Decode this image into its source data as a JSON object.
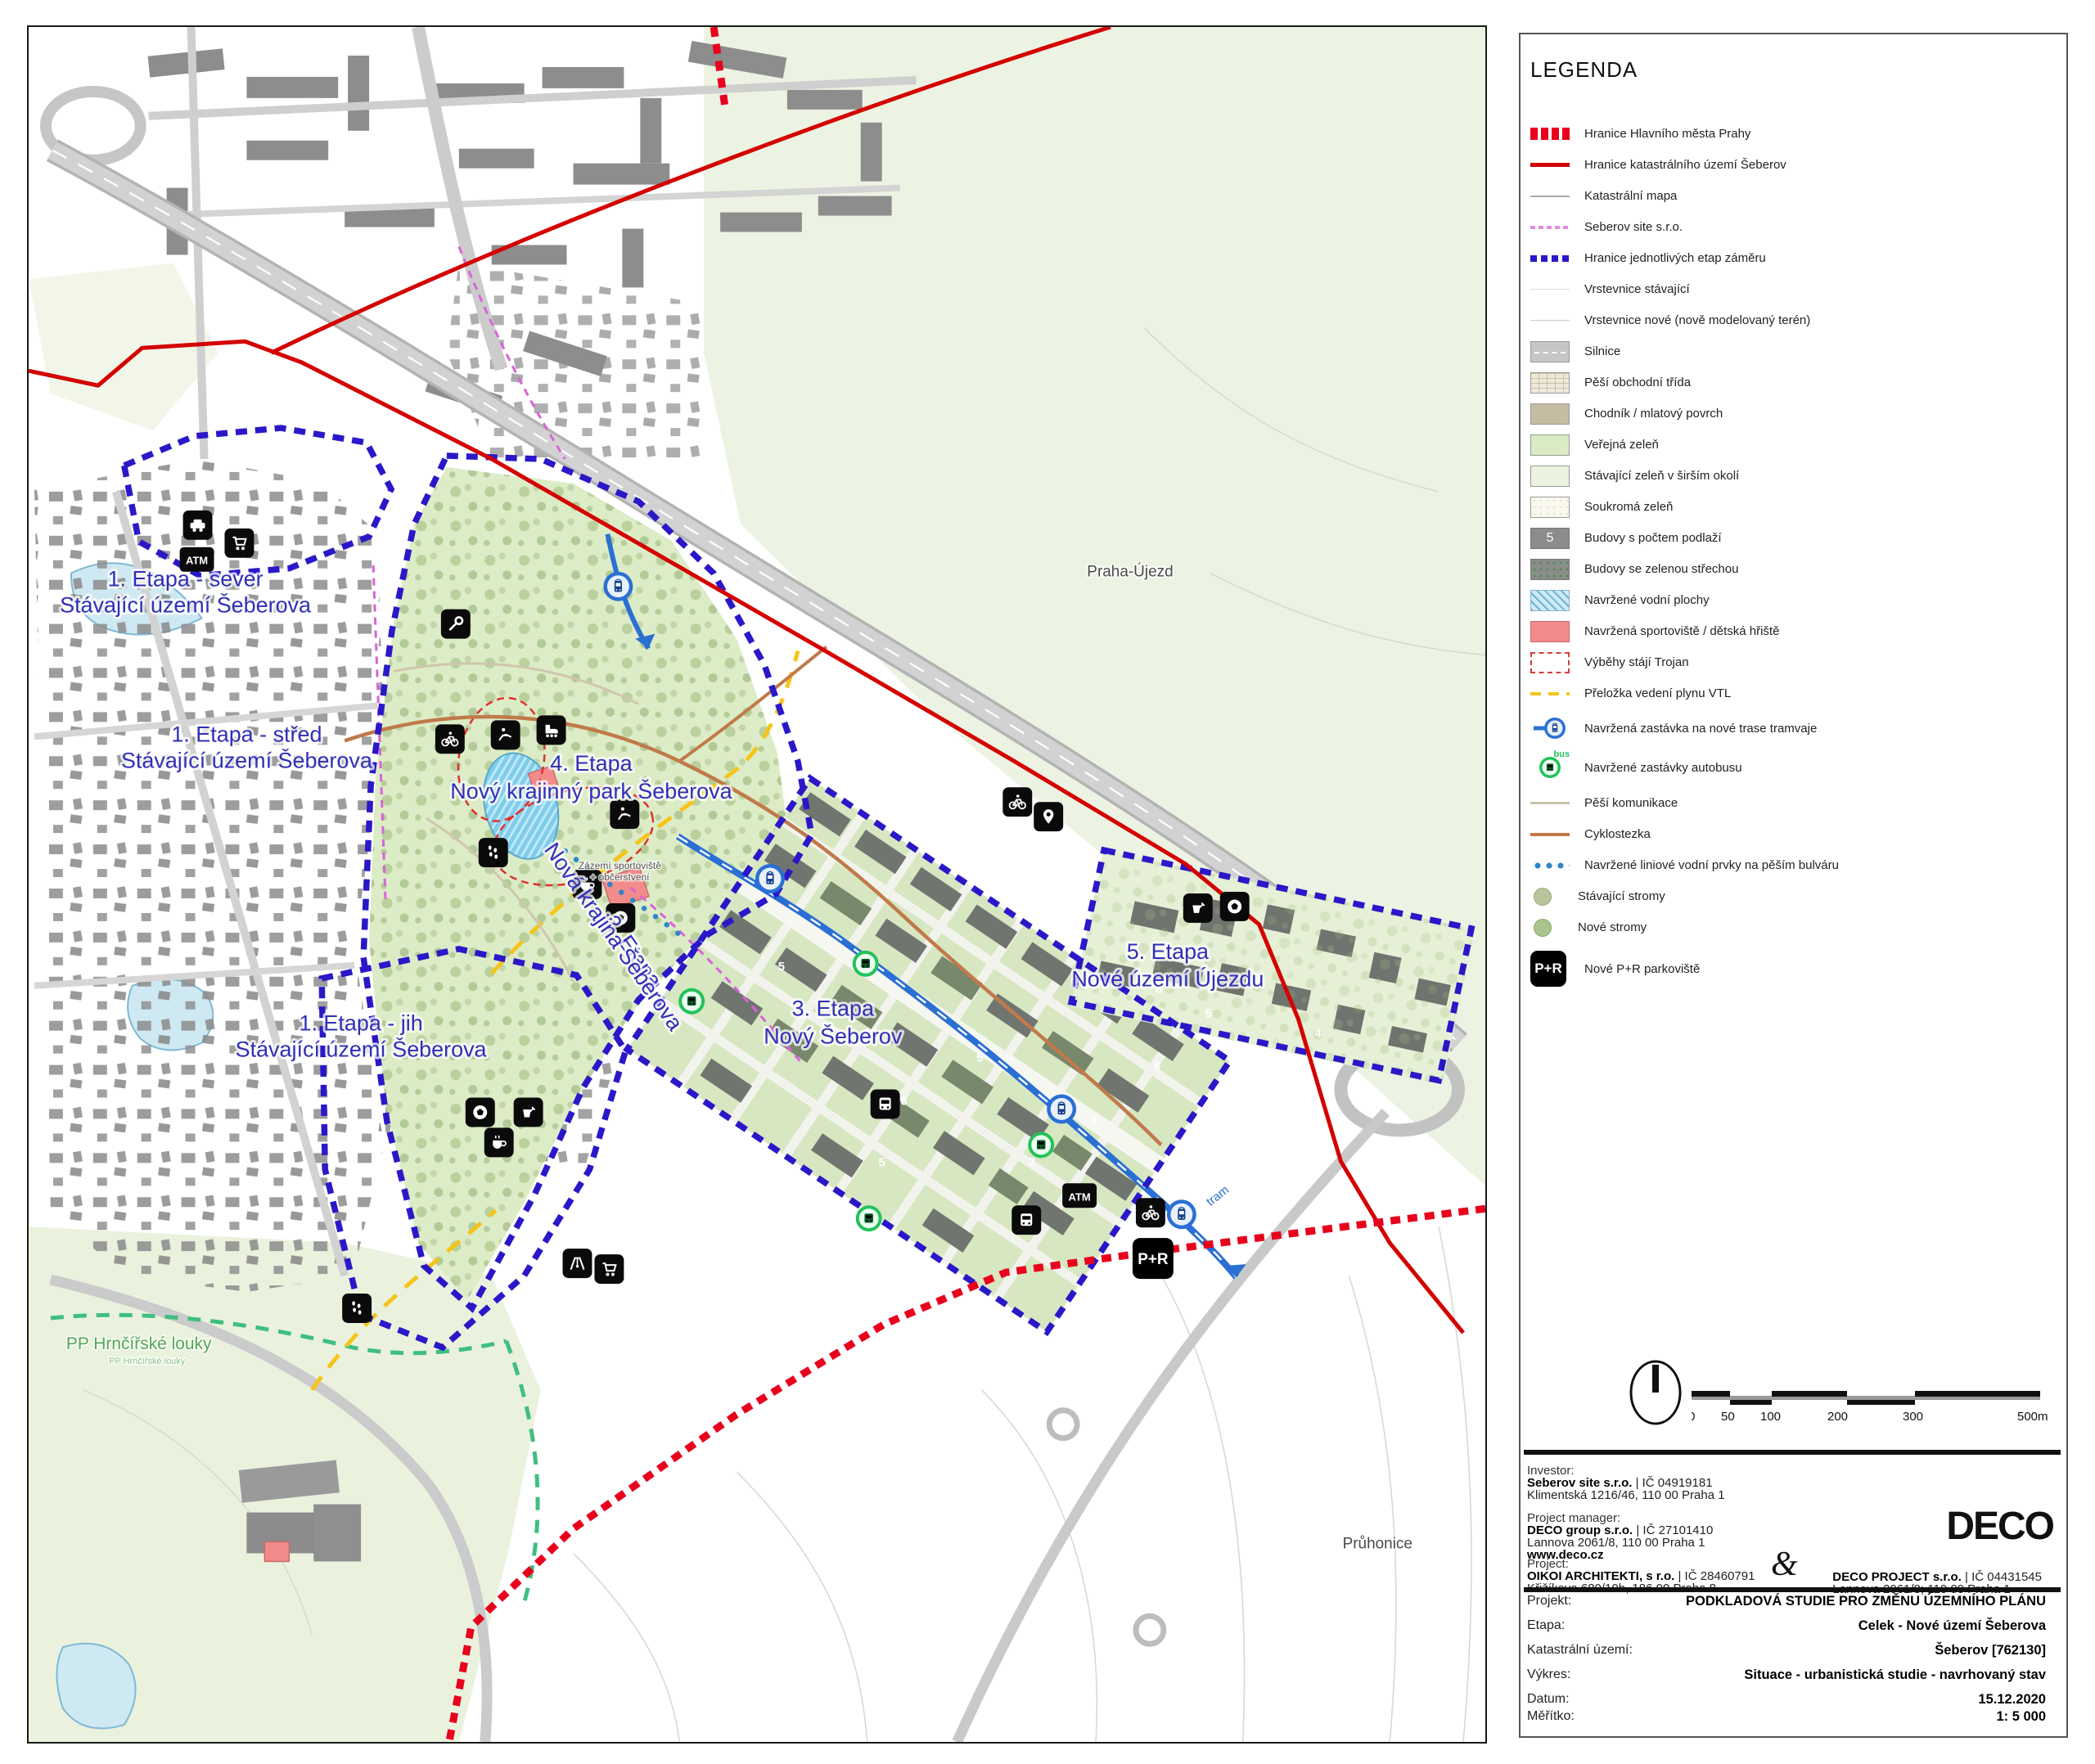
{
  "colors": {
    "etapa_boundary": "#2a18c8",
    "city_boundary_dotted": "#e8001c",
    "cadastre_line": "#d40000",
    "seberov_site_line": "#e08ae0",
    "public_green": "#d9ecc4",
    "park_green": "#dcecc6",
    "water": "#8fd2ee",
    "sport_red": "#f28c8a",
    "gas_yellow": "#f6c41a",
    "tram_blue": "#2a6fd4",
    "bus_green": "#23c25a",
    "label_blue": "#2f2fb8"
  },
  "map": {
    "labels": {
      "etapa1_sever_1": "1. Etapa - sever",
      "etapa1_sever_2": "Stávající území Šeberova",
      "etapa1_stred_1": "1. Etapa - střed",
      "etapa1_stred_2": "Stávající území Šeberova",
      "etapa1_jih_1": "1. Etapa - jih",
      "etapa1_jih_2": "Stávající území Šeberova",
      "etapa2_1": "2. Etapa",
      "etapa2_2": "Nová krajina Šeberova",
      "etapa3_1": "3. Etapa",
      "etapa3_2": "Nový Šeberov",
      "etapa4_1": "4. Etapa",
      "etapa4_2": "Nový krajinný park Šeberova",
      "etapa5_1": "5. Etapa",
      "etapa5_2": "Nové území Újezdu",
      "praha_ujezd": "Praha-Újezd",
      "pruhonice": "Průhonice",
      "pp_louky": "PP Hrnčířské louky",
      "pp_louky_sub": "PP Hrnčířské louky",
      "tram": "tram",
      "zazemi_1": "Zázemí sportoviště",
      "zazemi_2": "+ občerstvení"
    },
    "badges": {
      "atm": "ATM",
      "pr": "P+R"
    },
    "floors": [
      "5",
      "4",
      "6",
      "5",
      "7",
      "4",
      "6",
      "5",
      "8",
      "5",
      "5",
      "4"
    ],
    "icons": {
      "car-icon": "car service",
      "atm-icon": "ATM",
      "cart-icon": "shop",
      "wrench-icon": "services",
      "bike-icon": "cycling",
      "horse-icon": "horse riding",
      "skate-icon": "skating",
      "footprints-icon": "walking trail",
      "coffee-icon": "refreshment",
      "ball-icon": "sports field",
      "bucket-icon": "playground sandpit",
      "playground-icon": "playground",
      "pin-icon": "point of interest",
      "bus-front-icon": "bus station",
      "tram-stop-icon": "proposed tram stop",
      "bus-stop-icon": "proposed bus stop",
      "pr-icon": "P+R parking"
    }
  },
  "legend": {
    "title": "LEGENDA",
    "items": [
      {
        "label": "Hranice Hlavního města Prahy"
      },
      {
        "label": "Hranice katastrálního území Šeberov"
      },
      {
        "label": "Katastrální mapa"
      },
      {
        "label": "Seberov site s.r.o."
      },
      {
        "label": "Hranice jednotlivých etap záměru"
      },
      {
        "label": "Vrstevnice stávající"
      },
      {
        "label": "Vrstevnice nové (nově modelovaný terén)"
      },
      {
        "label": "Silnice"
      },
      {
        "label": "Pěší obchodní třída"
      },
      {
        "label": "Chodník / mlatový povrch"
      },
      {
        "label": "Veřejná zeleň"
      },
      {
        "label": "Stávající zeleň v širším okolí"
      },
      {
        "label": "Soukromá zeleň"
      },
      {
        "label": "Budovy s počtem podlaží",
        "badge": "5"
      },
      {
        "label": "Budovy se zelenou střechou"
      },
      {
        "label": "Navržené vodní plochy"
      },
      {
        "label": "Navržená sportoviště / dětská hřiště"
      },
      {
        "label": "Výběhy stájí Trojan"
      },
      {
        "label": "Přeložka vedení plynu VTL"
      },
      {
        "label": "Navržená zastávka na nové trase tramvaje"
      },
      {
        "label": "Navržené zastávky autobusu",
        "badge": "bus"
      },
      {
        "label": "Pěší komunikace"
      },
      {
        "label": "Cyklostezka"
      },
      {
        "label": "Navržené liniové vodní prvky na pěším bulváru"
      },
      {
        "label": "Stávající stromy"
      },
      {
        "label": "Nové stromy"
      },
      {
        "label": "Nové P+R parkoviště",
        "badge": "P+R"
      }
    ]
  },
  "scalebar": {
    "ticks": [
      "0",
      "50",
      "100",
      "200",
      "300",
      "500m"
    ]
  },
  "titleblock": {
    "investor_label": "Investor:",
    "investor_name": "Seberov site  s.r.o.",
    "investor_reg": "| IČ 04919181",
    "investor_addr": "Klimentská 1216/46, 110 00 Praha 1",
    "pm_label": "Project manager:",
    "pm_name": "DECO group s.r.o.",
    "pm_reg": "| IČ 27101410",
    "pm_addr": "Lannova 2061/8, 110 00 Praha 1",
    "pm_web": "www.deco.cz",
    "project_label": "Project:",
    "arch_name": "OIKOI ARCHITEKTI, s r.o.",
    "arch_reg": "| IČ 28460791",
    "arch_addr": "Křižíkova 680/10b, 186 00 Praha 8",
    "ampersand": "&",
    "deco_project_name": "DECO PROJECT s.r.o.",
    "deco_project_reg": "| IČ 04431545",
    "deco_project_addr": "Lannova 2061/8; 110 00 Praha 1",
    "logo": "DECO",
    "table": [
      {
        "label": "Projekt:",
        "value": "PODKLADOVÁ STUDIE PRO ZMĚNU ÚZEMNÍHO PLÁNU"
      },
      {
        "label": "Etapa:",
        "value": "Celek - Nové území Šeberova"
      },
      {
        "label": "Katastrální území:",
        "value": "Šeberov [762130]"
      },
      {
        "label": "Výkres:",
        "value": "Situace - urbanistická studie - navrhovaný stav"
      },
      {
        "label": "Datum:",
        "value": "15.12.2020"
      },
      {
        "label": "Měřítko:",
        "value": "1: 5 000"
      }
    ]
  }
}
